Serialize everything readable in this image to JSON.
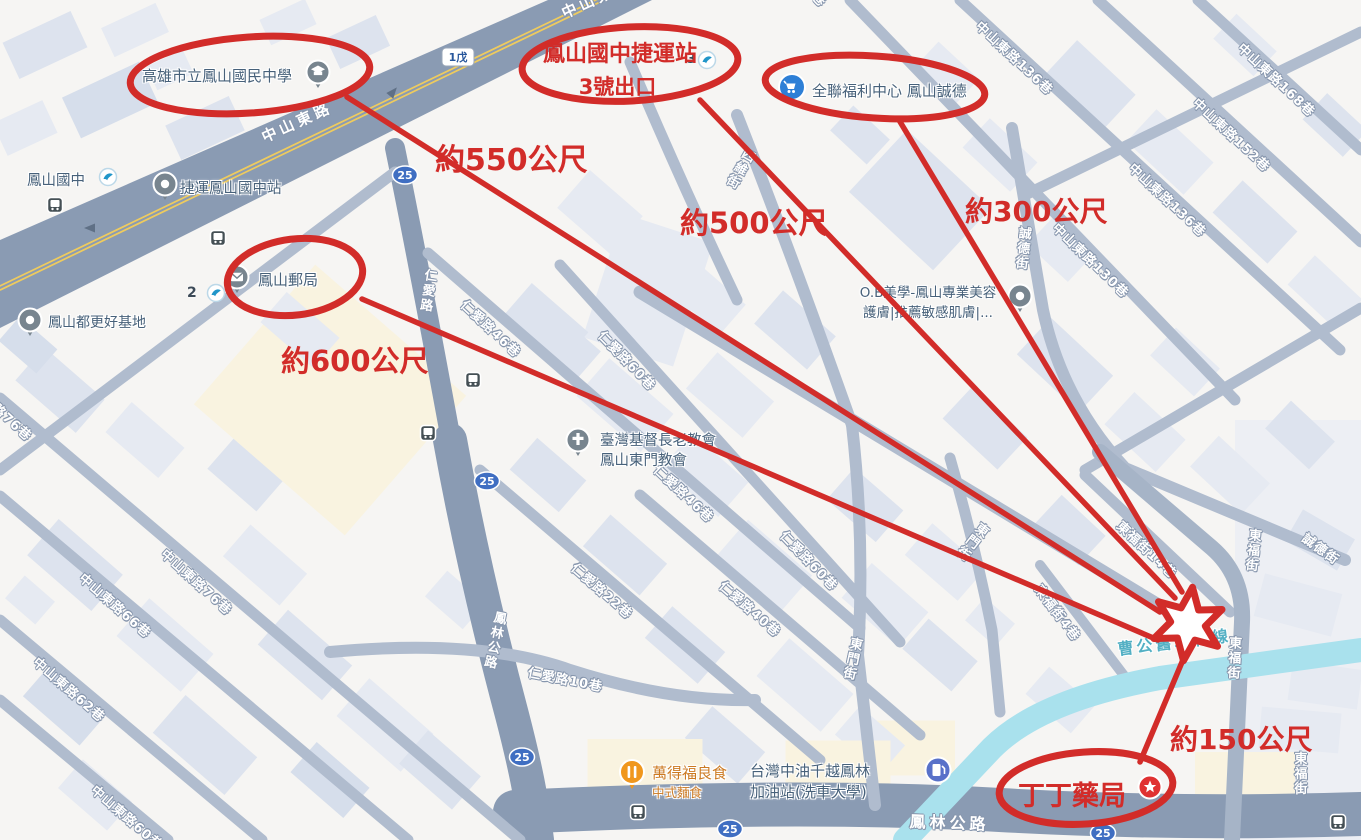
{
  "colors": {
    "annotation_red": "#d22c29",
    "road_fill": "#8a9bb3",
    "minor_road": "#b0bcce",
    "canal": "#a9e1ed",
    "background": "#f6f5f3"
  },
  "annotations": {
    "circled": {
      "mrt_line1": "鳳山國中捷運站",
      "mrt_line2": "3號出口",
      "pharmacy": "丁丁藥局"
    },
    "distances": {
      "school": "約550公尺",
      "mrt": "約500公尺",
      "pxmart": "約300公尺",
      "post_office": "約600公尺",
      "pharmacy": "約150公尺"
    }
  },
  "pois": {
    "school": "高雄市立鳳山國民中學",
    "fengshan_junior_high": "鳳山國中",
    "mrt_station": "捷運鳳山國中站",
    "exit_2": "2",
    "exit_3": "3",
    "post_office": "鳳山郵局",
    "urban_renewal_base": "鳳山都更好基地",
    "px_mart": "全聯福利中心 鳳山誠德",
    "beauty_line1": "O.B美學-鳳山專業美容",
    "beauty_line2": "護膚|推薦敏感肌膚|...",
    "church_line1": "臺灣基督長老教會",
    "church_line2": "鳳山東門教會",
    "restaurant": "萬得福良食",
    "restaurant_sub": "中式麵食",
    "gas_station_line1": "台灣中油千越鳳林",
    "gas_station_line2": "加油站(洗車大學)"
  },
  "streets": {
    "zhongshan_e_rd": "中山東路",
    "renai_rd": "仁愛路",
    "fenglin_rd": "鳳林公路",
    "dongfu_st": "東福街",
    "dongmen_st": "東門街",
    "chengde_st": "誠德街",
    "siwei_st": "四維街",
    "canal": "曹公舊圳幹線",
    "zs_lane_60": "中山東路60巷",
    "zs_lane_62": "中山東路62巷",
    "zs_lane_66": "中山東路66巷",
    "zs_lane_76": "中山東路76巷",
    "zs_lane_130": "中山東路130巷",
    "zs_lane_136": "中山東路136巷",
    "zs_lane_152": "中山東路152巷",
    "zs_lane_168": "中山東路168巷",
    "ra_lane_10": "仁愛路10巷",
    "ra_lane_22": "仁愛路22巷",
    "ra_lane_40": "仁愛路40巷",
    "ra_lane_46": "仁愛路46巷",
    "ra_lane_60": "仁愛路60巷",
    "df_lane_4": "東福街4巷",
    "df_lane_14": "東福街14巷"
  },
  "shields": {
    "provincial_1w": "1戊",
    "county_25": "25"
  }
}
